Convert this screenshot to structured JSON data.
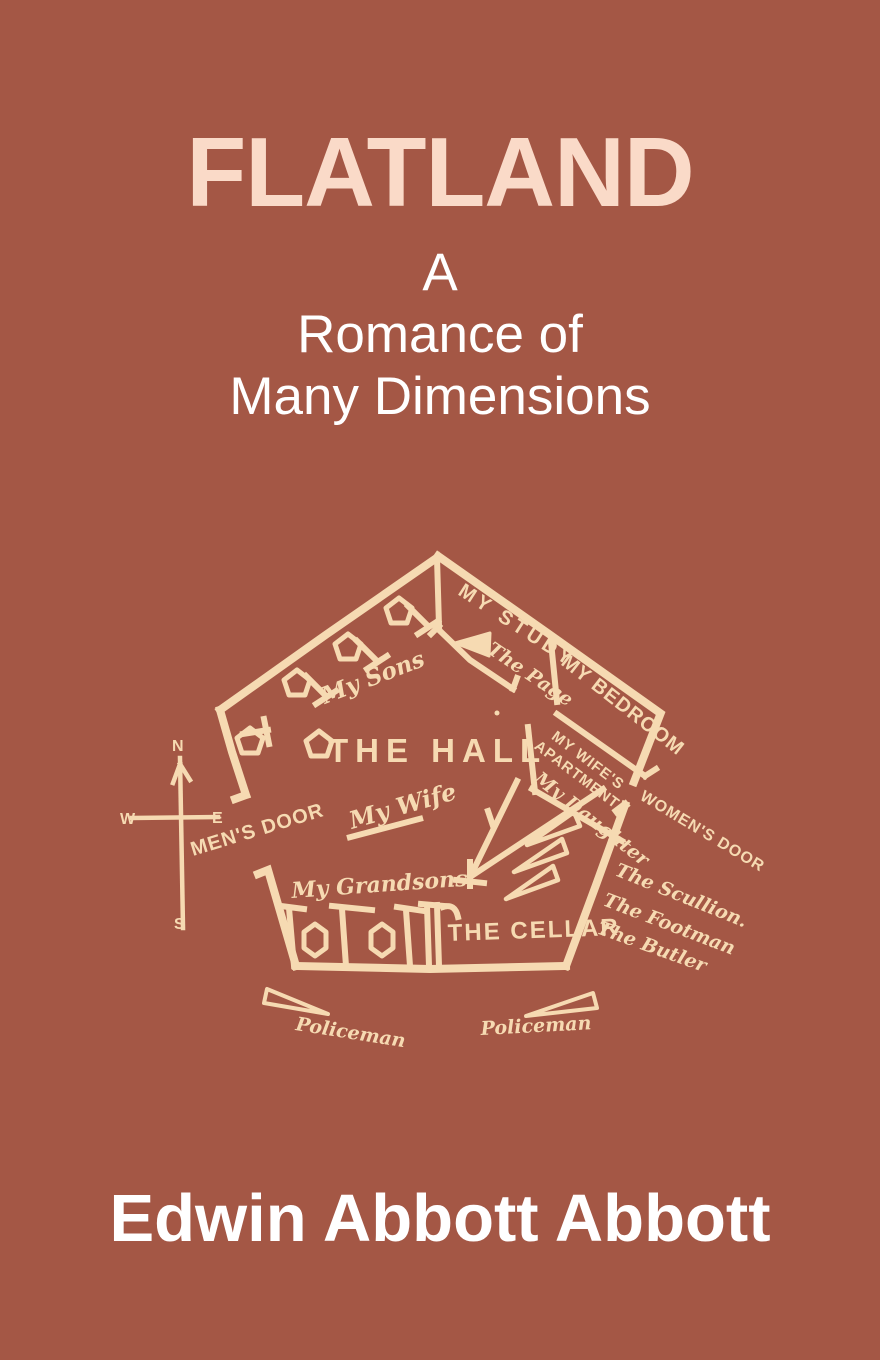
{
  "cover": {
    "title": "FLATLAND",
    "subtitle_lines": [
      "A",
      "Romance of",
      "Many Dimensions"
    ],
    "author": "Edwin Abbott Abbott",
    "colors": {
      "background": "#A45745",
      "title_text": "#FADAC8",
      "subtitle_text": "#FFFFFF",
      "author_text": "#FFFFFF",
      "diagram_ink": "#F6DAB2"
    }
  },
  "diagram": {
    "labels": {
      "my_study": "MY STUDY",
      "the_page": "The Page",
      "my_bedroom": "MY BEDROOM",
      "my_sons": "My Sons",
      "the_hall": "THE HALL",
      "wifes_apartment_l1": "MY WIFE'S",
      "wifes_apartment_l2": "APARTMENT",
      "my_daughter": "My Daughter",
      "womens_door": "WOMEN'S DOOR",
      "mens_door": "MEN'S DOOR",
      "my_wife": "My Wife",
      "my_grandsons": "My Grandsons",
      "the_cellar": "THE CELLAR",
      "the_scullion": "The Scullion.",
      "the_footman": "The Footman",
      "the_butler": "The Butler",
      "policeman_left": "Policeman",
      "policeman_right": "Policeman"
    },
    "compass": {
      "n": "N",
      "e": "E",
      "s": "S",
      "w": "W"
    }
  }
}
